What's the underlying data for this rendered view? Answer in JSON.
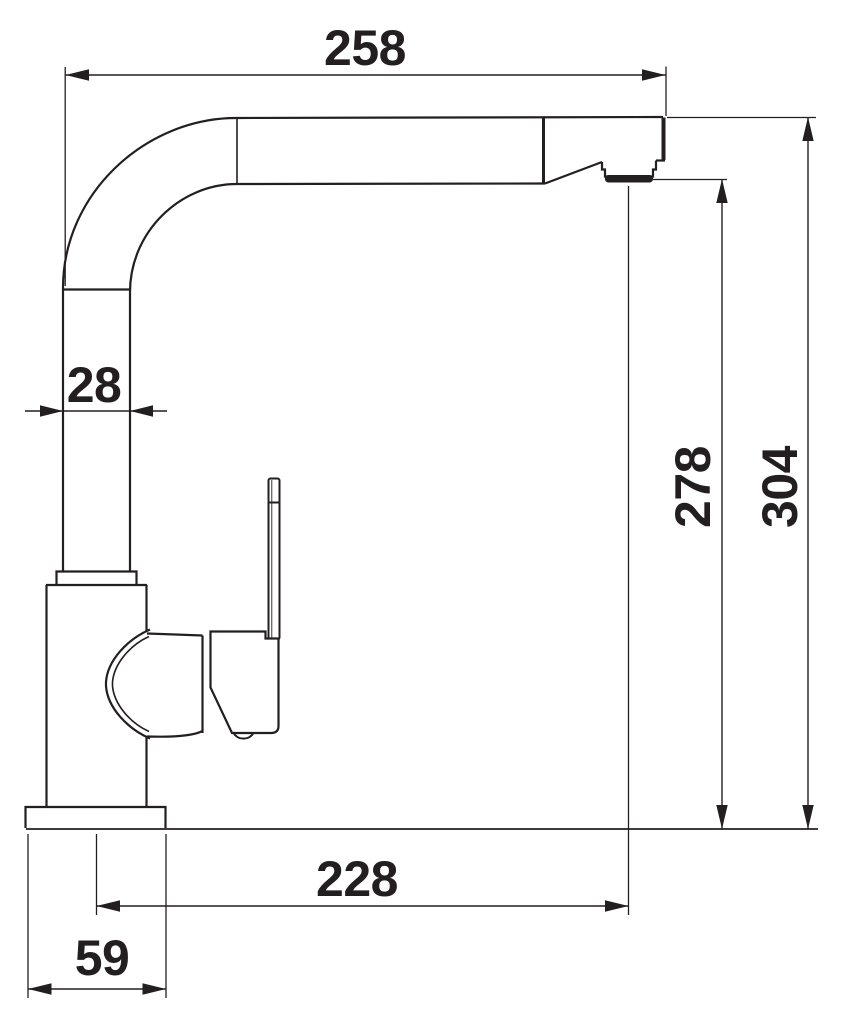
{
  "drawing": {
    "type": "technical dimension drawing, kitchen mixer tap side elevation",
    "background_color": "#ffffff",
    "line_color": "#231f20",
    "dimensions": [
      {
        "id": "spout-reach-top",
        "value": "258",
        "orientation": "horizontal"
      },
      {
        "id": "spout-tube-width",
        "value": "28",
        "orientation": "horizontal"
      },
      {
        "id": "outlet-height",
        "value": "278",
        "orientation": "vertical"
      },
      {
        "id": "overall-height",
        "value": "304",
        "orientation": "vertical"
      },
      {
        "id": "outlet-projection",
        "value": "228",
        "orientation": "horizontal"
      },
      {
        "id": "base-width",
        "value": "59",
        "orientation": "horizontal"
      }
    ]
  }
}
